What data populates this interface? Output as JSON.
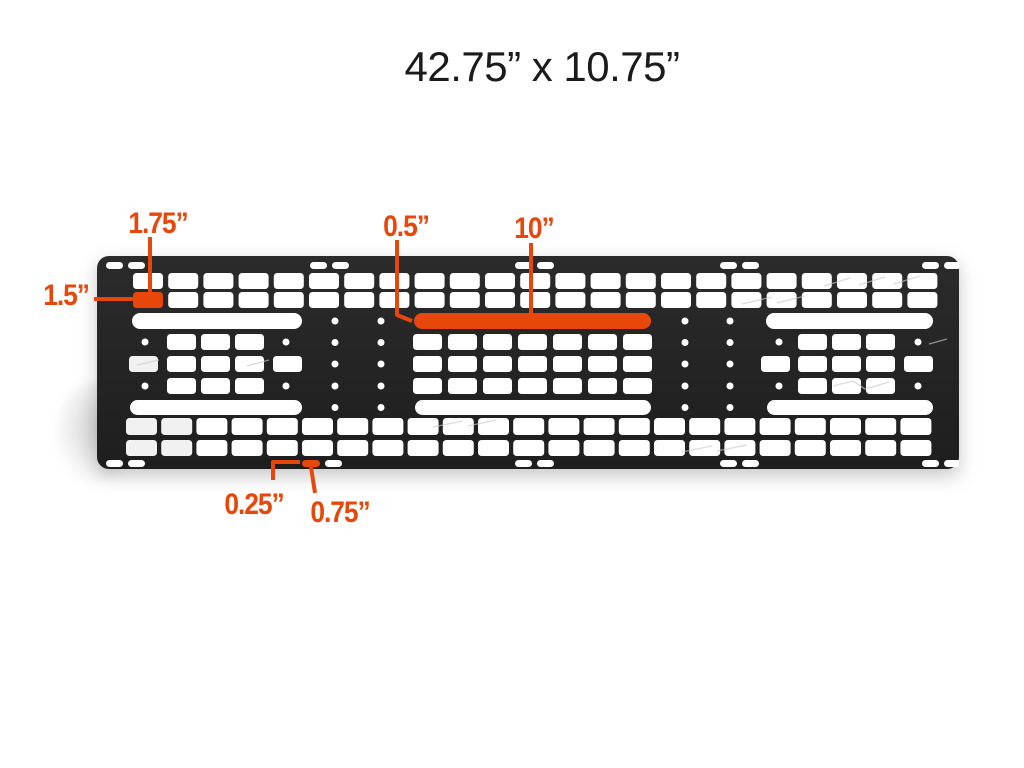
{
  "title": "42.75” x 10.75”",
  "colors": {
    "accent": "#E8470C",
    "panel_dark_top": "#2b2b2b",
    "panel_dark_bottom": "#1e1e1e",
    "slot_white": "#ffffff",
    "background": "#ffffff"
  },
  "panel": {
    "name": "molle-mounting-panel",
    "overall_width": "42.75”",
    "overall_height": "10.75”"
  },
  "callouts": [
    {
      "id": "slot-pitch",
      "text": "1.75”"
    },
    {
      "id": "slot-height",
      "text": "1.5”"
    },
    {
      "id": "long-slot-offset",
      "text": "0.5”"
    },
    {
      "id": "long-slot-length",
      "text": "10”"
    },
    {
      "id": "edge-slot-gap",
      "text": "0.25”"
    },
    {
      "id": "edge-slot-width",
      "text": "0.75”"
    }
  ]
}
